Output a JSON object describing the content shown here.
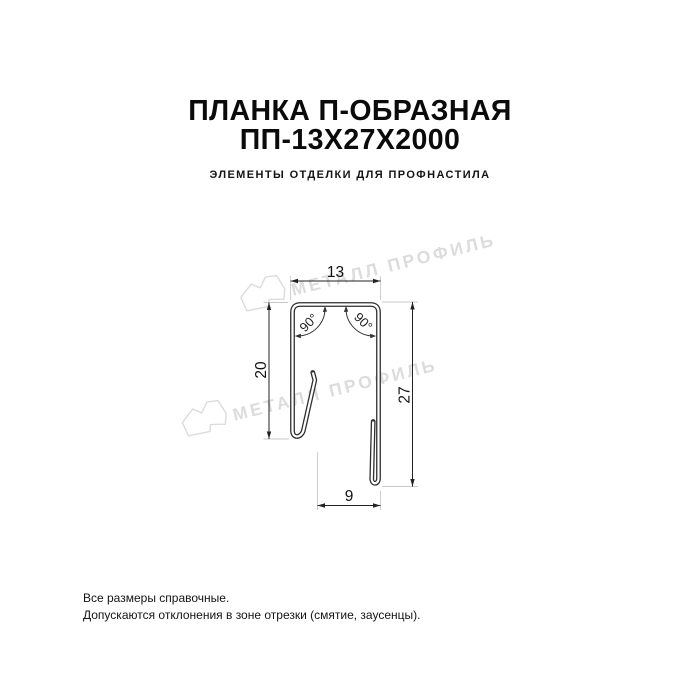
{
  "header": {
    "title_line1": "ПЛАНКА П-ОБРАЗНАЯ",
    "title_line2": "ПП-13Х27Х2000",
    "subtitle": "ЭЛЕМЕНТЫ ОТДЕЛКИ ДЛЯ ПРОФНАСТИЛА"
  },
  "diagram": {
    "product_shape": "u-profile-cross-section",
    "dimensions": {
      "top_width": "13",
      "left_height": "20",
      "right_height": "27",
      "bottom_width": "9",
      "angle_left": "90°",
      "angle_right": "90°"
    },
    "colors": {
      "outline": "#2f2f2f",
      "dimension": "#222222",
      "extension_line": "#c9c9c9",
      "watermark": "#dcdcdc"
    }
  },
  "watermark": {
    "text": "МЕТАЛЛ ПРОФИЛЬ",
    "logo": "metall-profil-logo"
  },
  "footer": {
    "line1": "Все размеры справочные.",
    "line2": "Допускаются отклонения в зоне отрезки (смятие, заусенцы)."
  }
}
